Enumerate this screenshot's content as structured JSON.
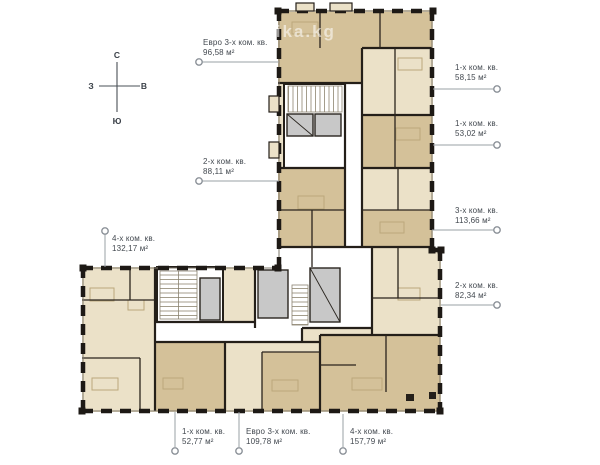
{
  "watermark": "lika.kg",
  "compass": {
    "north": "С",
    "south": "Ю",
    "west": "З",
    "east": "В"
  },
  "apartments": [
    {
      "type": "Евро 3-х ком. кв.",
      "area": "96,58 м²"
    },
    {
      "type": "2-х ком. кв.",
      "area": "88,11 м²"
    },
    {
      "type": "1-х ком. кв.",
      "area": "58,15 м²"
    },
    {
      "type": "1-х ком. кв.",
      "area": "53,02 м²"
    },
    {
      "type": "3-х ком. кв.",
      "area": "113,66 м²"
    },
    {
      "type": "2-х ком. кв.",
      "area": "82,34 м²"
    },
    {
      "type": "4-х ком. кв.",
      "area": "132,17 м²"
    },
    {
      "type": "1-х ком. кв.",
      "area": "52,77 м²"
    },
    {
      "type": "Евро 3-х ком. кв.",
      "area": "109,78 м²"
    },
    {
      "type": "4-х ком. кв.",
      "area": "157,79 м²"
    }
  ],
  "colors": {
    "wall": "#241f19",
    "apartment_fill_light": "#ebe1c8",
    "apartment_fill_dark": "#d4c199",
    "core_fill": "#ffffff",
    "elevator_fill": "#c8c8c8",
    "leader": "#9aa0a6",
    "label_text": "#42484f"
  }
}
